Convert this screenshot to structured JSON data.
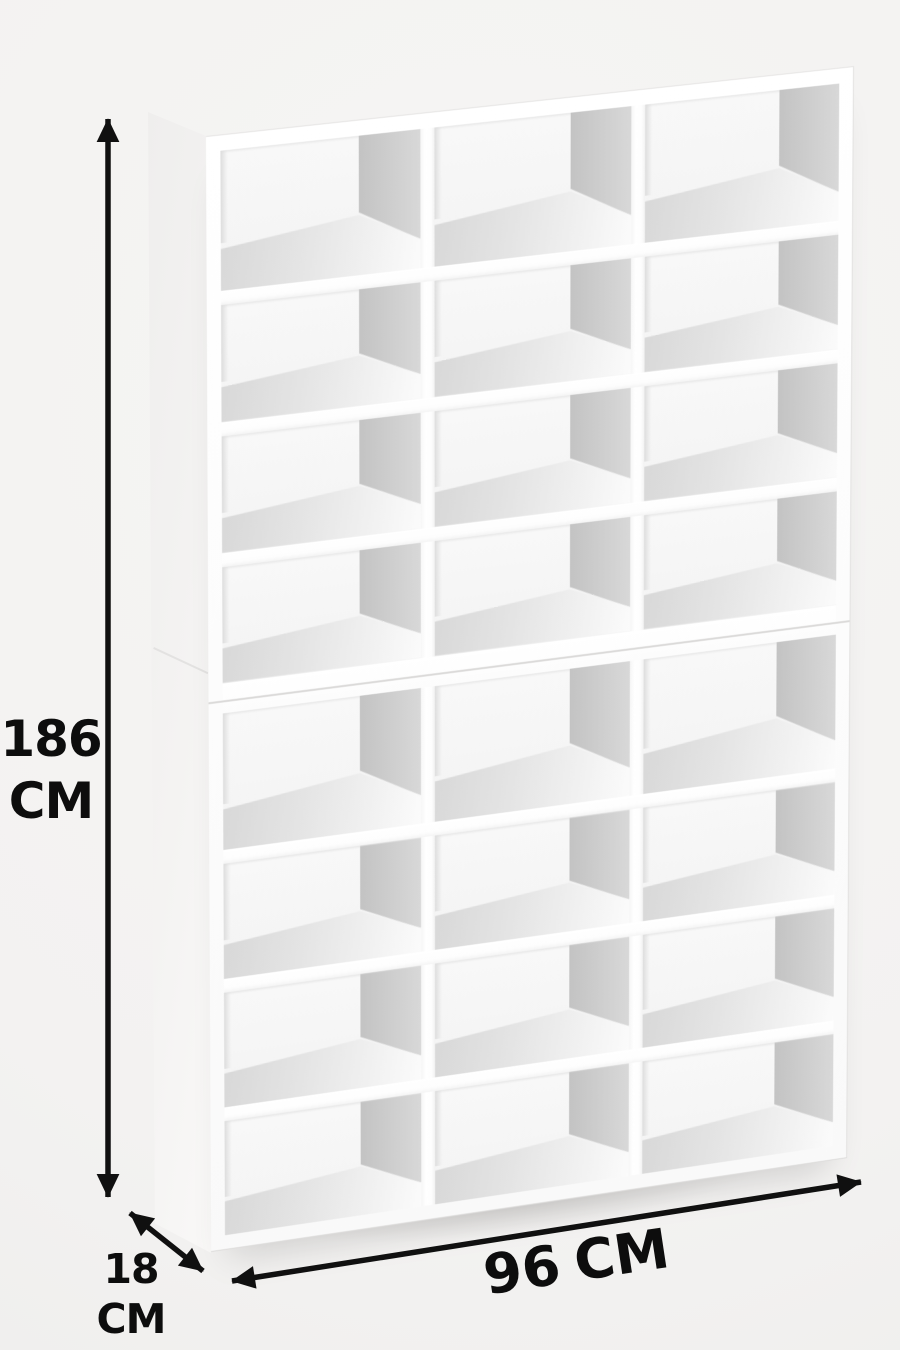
{
  "diagram": {
    "description": "white cube storage shelf with dimension arrows"
  },
  "dimensions": {
    "height": {
      "value": "186",
      "unit": "CM"
    },
    "depth": {
      "value": "18",
      "unit": "CM"
    },
    "width": {
      "value": "96",
      "unit": "CM"
    }
  },
  "shelf": {
    "boxes": 2,
    "rows_per_box": 4,
    "columns": 3,
    "total_cubbies": 24
  },
  "icons": {
    "height_arrow": "double-headed-vertical-arrow",
    "depth_arrow": "double-headed-diagonal-arrow",
    "width_arrow": "double-headed-horizontal-arrow"
  },
  "colors": {
    "background": "#f3f2f1",
    "arrow": "#101010",
    "text": "#0d0d0d",
    "board_white": "#fbfbfb",
    "wall_gray": "#cccccc",
    "floor_gray": "#e3e3e3"
  }
}
